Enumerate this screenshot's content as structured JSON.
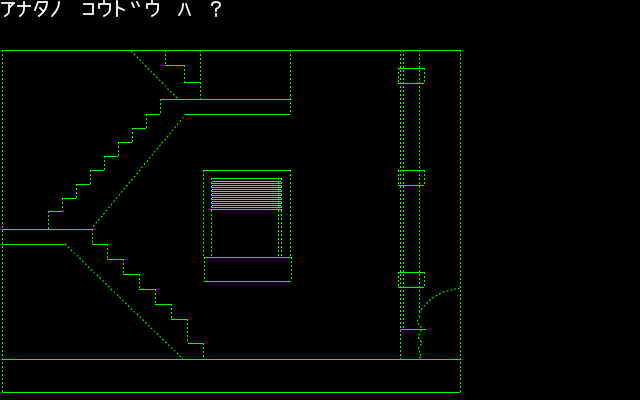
{
  "prompt": {
    "text": "アナタノ コウト゛ウ ハ ?",
    "color": "#ffffff"
  },
  "palette": {
    "background": "#000000",
    "line": "#00ff00",
    "blind": "#33ccff"
  },
  "scene": {
    "room": {
      "solid": [
        [
          2,
          50,
          461,
          50
        ],
        [
          2,
          359,
          461,
          359
        ],
        [
          2,
          392,
          460,
          392
        ]
      ],
      "dotted": [
        [
          2,
          50,
          2,
          392
        ],
        [
          460,
          50,
          460,
          392
        ]
      ]
    },
    "staircase": {
      "solid": [
        [
          165,
          65,
          184,
          65
        ],
        [
          184,
          82,
          200,
          82
        ],
        [
          160,
          99,
          290,
          99
        ],
        [
          185,
          114,
          290,
          114
        ],
        [
          146,
          114,
          160,
          114
        ],
        [
          132,
          128,
          146,
          128
        ],
        [
          118,
          142,
          132,
          142
        ],
        [
          104,
          156,
          118,
          156
        ],
        [
          90,
          170,
          104,
          170
        ],
        [
          76,
          184,
          90,
          184
        ],
        [
          62,
          198,
          76,
          198
        ],
        [
          48,
          211,
          62,
          211
        ],
        [
          2,
          229,
          92,
          229
        ],
        [
          2,
          244,
          65,
          244
        ],
        [
          92,
          244,
          107,
          244
        ],
        [
          107,
          259,
          123,
          259
        ],
        [
          123,
          274,
          139,
          274
        ],
        [
          139,
          289,
          155,
          289
        ],
        [
          155,
          304,
          171,
          304
        ],
        [
          171,
          319,
          187,
          319
        ],
        [
          188,
          343,
          203,
          343
        ]
      ],
      "dotted": [
        [
          165,
          50,
          165,
          65
        ],
        [
          184,
          65,
          184,
          82
        ],
        [
          200,
          50,
          200,
          99
        ],
        [
          290,
          50,
          290,
          114
        ],
        [
          131,
          51,
          178,
          99
        ],
        [
          160,
          99,
          160,
          114
        ],
        [
          146,
          114,
          146,
          128
        ],
        [
          132,
          128,
          132,
          142
        ],
        [
          118,
          142,
          118,
          156
        ],
        [
          104,
          156,
          104,
          170
        ],
        [
          90,
          170,
          90,
          184
        ],
        [
          76,
          184,
          76,
          198
        ],
        [
          62,
          198,
          62,
          211
        ],
        [
          48,
          211,
          48,
          229
        ],
        [
          186,
          114,
          92,
          228
        ],
        [
          92,
          229,
          92,
          244
        ],
        [
          107,
          244,
          107,
          259
        ],
        [
          123,
          259,
          123,
          274
        ],
        [
          139,
          274,
          139,
          289
        ],
        [
          155,
          289,
          155,
          304
        ],
        [
          171,
          304,
          171,
          319
        ],
        [
          187,
          319,
          187,
          343
        ],
        [
          203,
          343,
          203,
          359
        ],
        [
          65,
          244,
          183,
          359
        ]
      ]
    },
    "window": {
      "solid": [
        [
          203,
          170,
          290,
          170
        ],
        [
          211,
          178,
          282,
          178
        ],
        [
          211,
          209,
          282,
          209
        ],
        [
          204,
          257,
          292,
          257
        ],
        [
          204,
          281,
          291,
          281
        ]
      ],
      "dotted": [
        [
          203,
          170,
          203,
          257
        ],
        [
          290,
          170,
          290,
          257
        ],
        [
          211,
          178,
          211,
          257
        ],
        [
          281,
          178,
          281,
          257
        ],
        [
          278,
          178,
          278,
          257
        ],
        [
          204,
          257,
          204,
          281
        ],
        [
          291,
          257,
          291,
          281
        ]
      ],
      "blind": {
        "x1": 212,
        "x2": 281,
        "y": 181,
        "count": 14,
        "step": 2
      }
    },
    "pipe": {
      "solid": [
        [
          398,
          68,
          424,
          68
        ],
        [
          398,
          83,
          424,
          83
        ],
        [
          398,
          170,
          424,
          170
        ],
        [
          398,
          185,
          424,
          185
        ],
        [
          398,
          272,
          424,
          272
        ],
        [
          398,
          287,
          424,
          287
        ],
        [
          401,
          329,
          426,
          329
        ]
      ],
      "dotted": [
        [
          400,
          50,
          400,
          359
        ],
        [
          403,
          50,
          403,
          329
        ],
        [
          419,
          50,
          419,
          313
        ],
        [
          398,
          68,
          398,
          83
        ],
        [
          424,
          68,
          424,
          83
        ],
        [
          398,
          170,
          398,
          185
        ],
        [
          424,
          170,
          424,
          185
        ],
        [
          398,
          272,
          398,
          287
        ],
        [
          424,
          272,
          424,
          287
        ]
      ],
      "paths": [
        [
          [
            460,
            288
          ],
          [
            443,
            292
          ],
          [
            432,
            298
          ],
          [
            425,
            305
          ],
          [
            420,
            311
          ],
          [
            419,
            316
          ]
        ],
        [
          [
            420,
            316
          ],
          [
            417,
            322
          ],
          [
            421,
            327
          ],
          [
            421,
            331
          ],
          [
            418,
            337
          ],
          [
            422,
            343
          ],
          [
            418,
            349
          ],
          [
            421,
            354
          ],
          [
            419,
            357
          ],
          [
            422,
            359
          ]
        ]
      ]
    }
  }
}
